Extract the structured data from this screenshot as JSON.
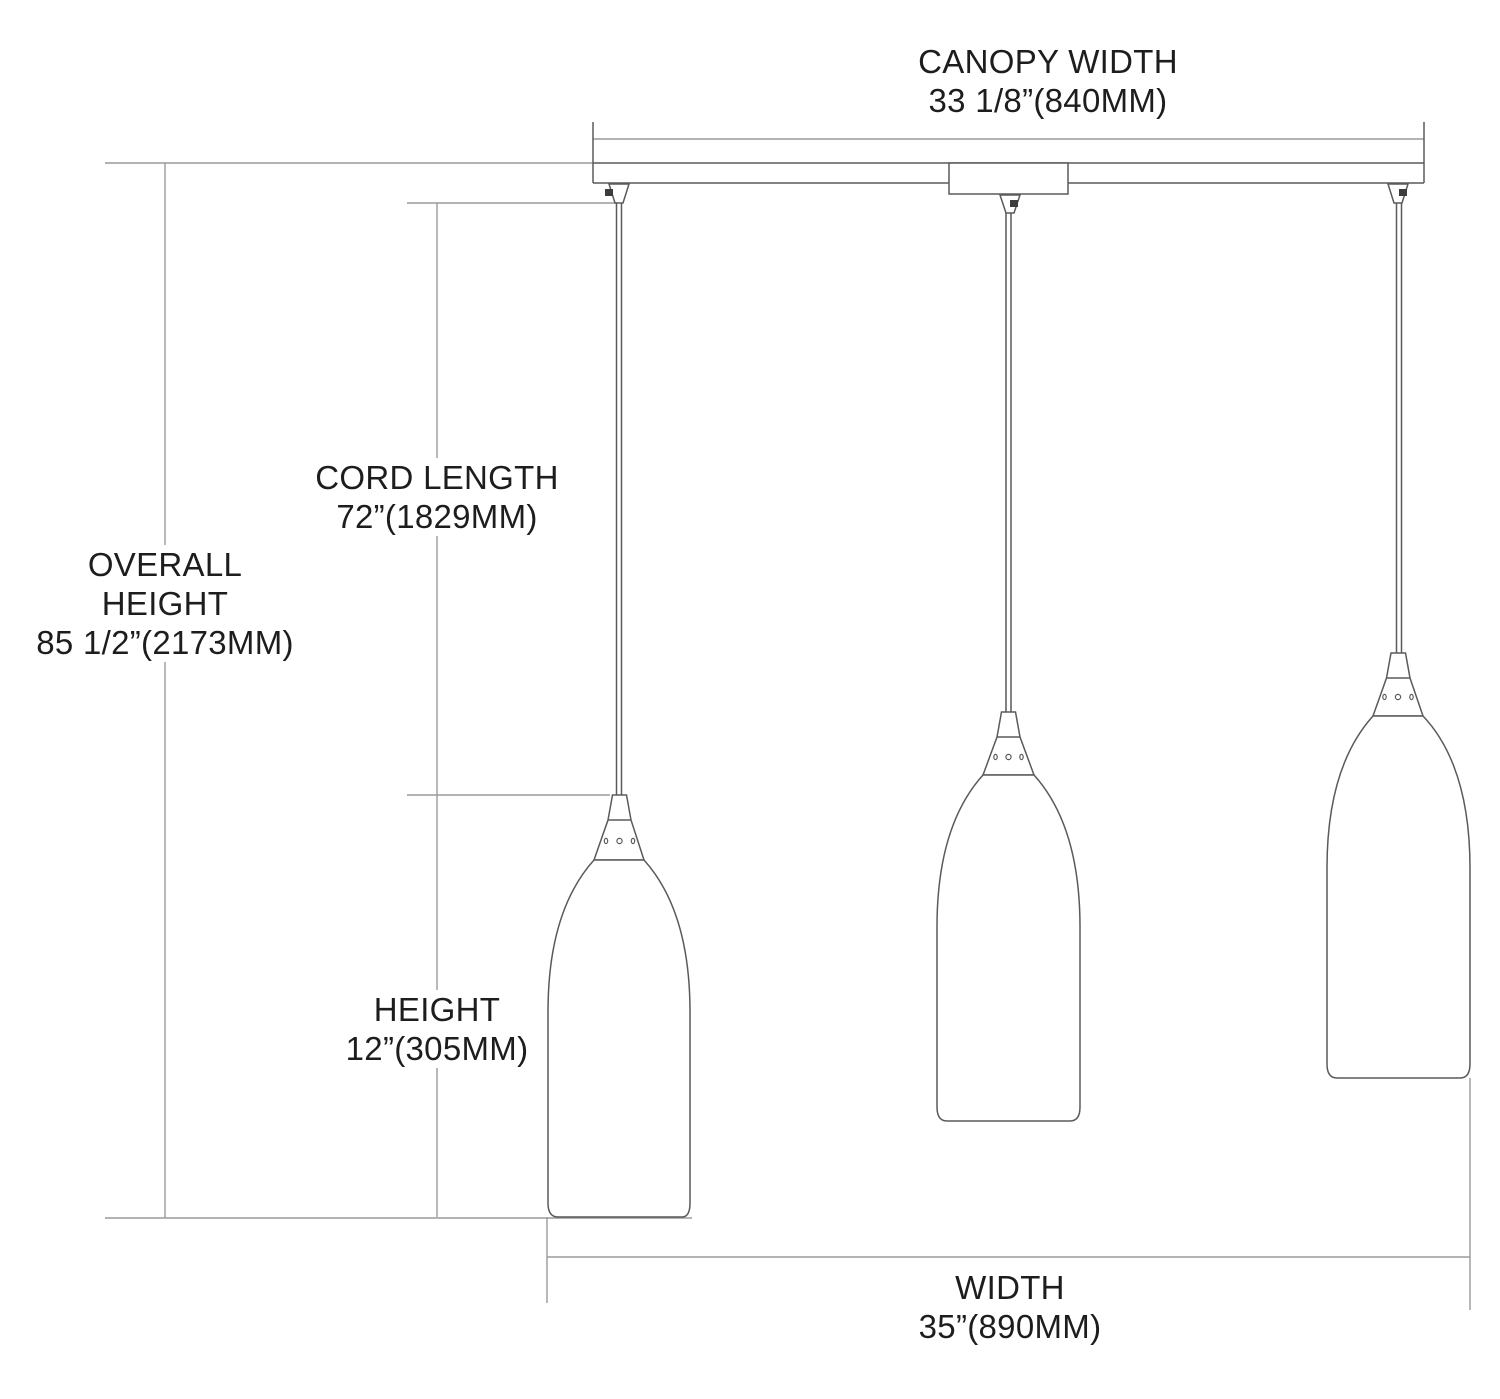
{
  "page": {
    "title": "Pendant fixture dimension diagram",
    "background": "#ffffff"
  },
  "colors": {
    "drawing_line": "#5a5a5a",
    "dimension_line": "#9a9a9a",
    "text": "#1d1d1d"
  },
  "labels": {
    "canopy_width": {
      "line1": "CANOPY WIDTH",
      "line2": "33 1/8”(840MM)"
    },
    "cord_length": {
      "line1": "CORD LENGTH",
      "line2": "72”(1829MM)"
    },
    "overall_height": {
      "line1": "OVERALL",
      "line2": "HEIGHT",
      "line3": "85 1/2”(2173MM)"
    },
    "shade_height": {
      "line1": "HEIGHT",
      "line2": "12”(305MM)"
    },
    "width": {
      "line1": "WIDTH",
      "line2": "35”(890MM)"
    }
  }
}
